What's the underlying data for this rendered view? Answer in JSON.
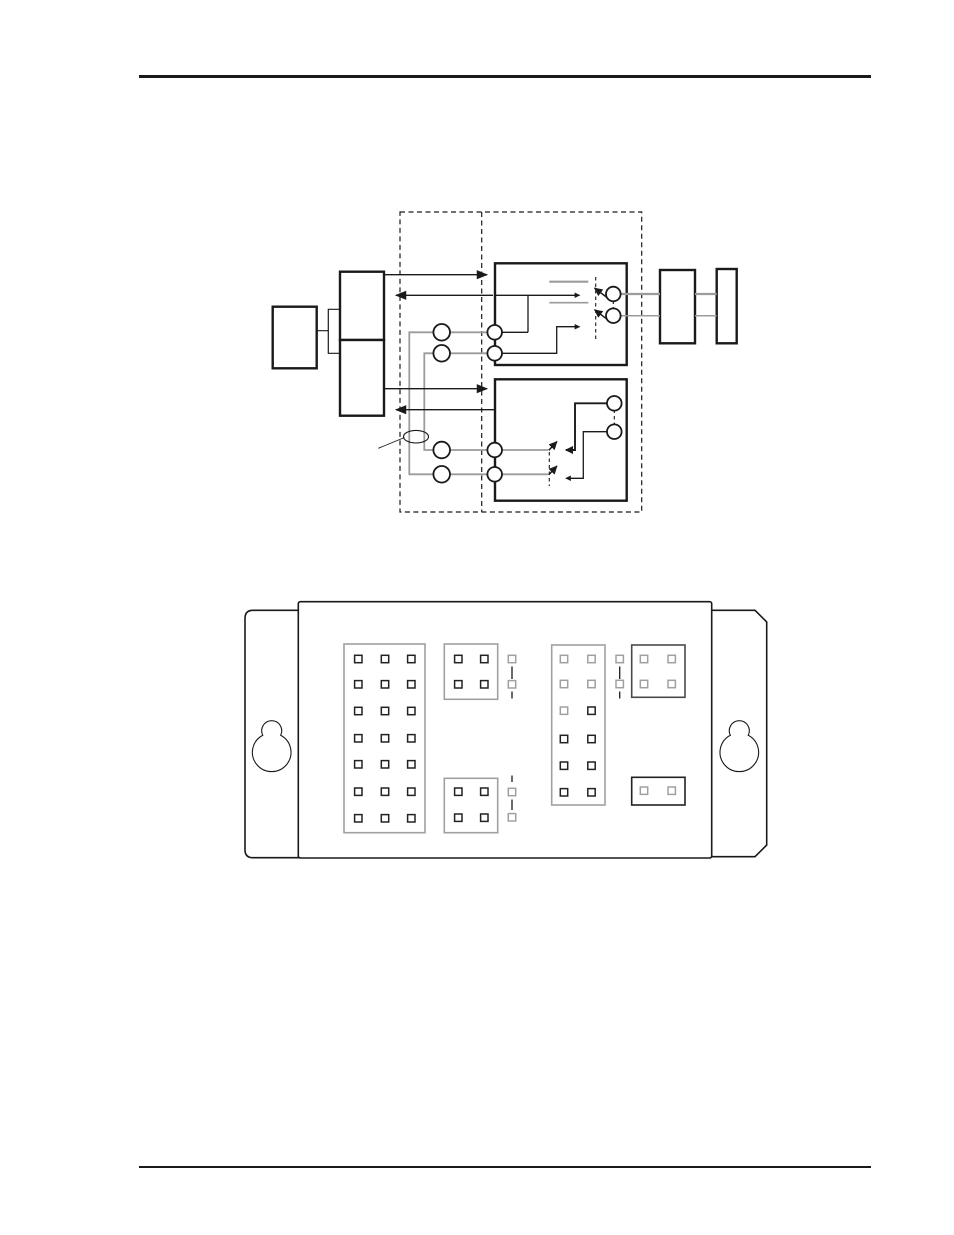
{
  "page": {
    "kind": "technical-manual-page",
    "background": "#ffffff",
    "header_rule_color": "#000000",
    "footer_rule_color": "#000000",
    "visible_text": ""
  },
  "colors": {
    "ink": "#1a1a1a",
    "wire_gray": "#9b9b9b",
    "block_outline_gray": "#a0a0a0",
    "block_outline_dark": "#4a4a4a",
    "block_outline_black": "#222222",
    "pin_black": "#222222",
    "pin_gray": "#a0a0a0",
    "page_bg": "#ffffff"
  },
  "block_diagram": {
    "description": "signal routing diagram: host equipment on left, dashed demarcation area with terminal pairs, two relay switch modules, network boxes on right",
    "left_terminal_circles": 4,
    "module_terminal_circles": 4,
    "relay_contact_circles": 4,
    "switch_blades": 4,
    "arrows_right": 2,
    "arrows_left": 2,
    "wire_pair_callout": "ellipse-around-wire-pair"
  },
  "panel": {
    "description": "wall-mount unit top view with two keyhole mounting flanges and jumper pin blocks",
    "keyholes": 2,
    "blocks": [
      {
        "name": "jumper-block-a",
        "cols": 3,
        "rows": 7,
        "outline": "gray",
        "pins": [
          [
            "b",
            "b",
            "b"
          ],
          [
            "b",
            "b",
            "b"
          ],
          [
            "b",
            "b",
            "b"
          ],
          [
            "b",
            "b",
            "b"
          ],
          [
            "b",
            "b",
            "b"
          ],
          [
            "b",
            "b",
            "b"
          ],
          [
            "b",
            "b",
            "b"
          ]
        ]
      },
      {
        "name": "jumper-block-b-top",
        "cols": 2,
        "rows": 2,
        "outline": "gray",
        "pins": [
          [
            "b",
            "b"
          ],
          [
            "b",
            "b"
          ]
        ]
      },
      {
        "name": "jumper-block-b-bottom",
        "cols": 2,
        "rows": 2,
        "outline": "gray",
        "pins": [
          [
            "b",
            "b"
          ],
          [
            "b",
            "b"
          ]
        ]
      },
      {
        "name": "jumper-block-c",
        "cols": 2,
        "rows": 6,
        "outline": "gray",
        "pins": [
          [
            "g",
            "g"
          ],
          [
            "g",
            "g"
          ],
          [
            "g",
            "b"
          ],
          [
            "b",
            "b"
          ],
          [
            "b",
            "b"
          ],
          [
            "b",
            "b"
          ]
        ]
      },
      {
        "name": "jumper-block-d-top",
        "cols": 2,
        "rows": 2,
        "outline": "dark",
        "pins": [
          [
            "g",
            "g"
          ],
          [
            "g",
            "g"
          ]
        ]
      },
      {
        "name": "jumper-block-d-bottom",
        "cols": 2,
        "rows": 1,
        "outline": "black",
        "pins": [
          [
            "g",
            "g"
          ]
        ]
      }
    ],
    "pin_links": [
      {
        "name": "pin-link-1",
        "pins": "gray",
        "squares": 2
      },
      {
        "name": "pin-link-2",
        "pins": "gray",
        "squares": 2
      },
      {
        "name": "pin-link-3",
        "pins": "gray",
        "squares": 2
      }
    ]
  }
}
